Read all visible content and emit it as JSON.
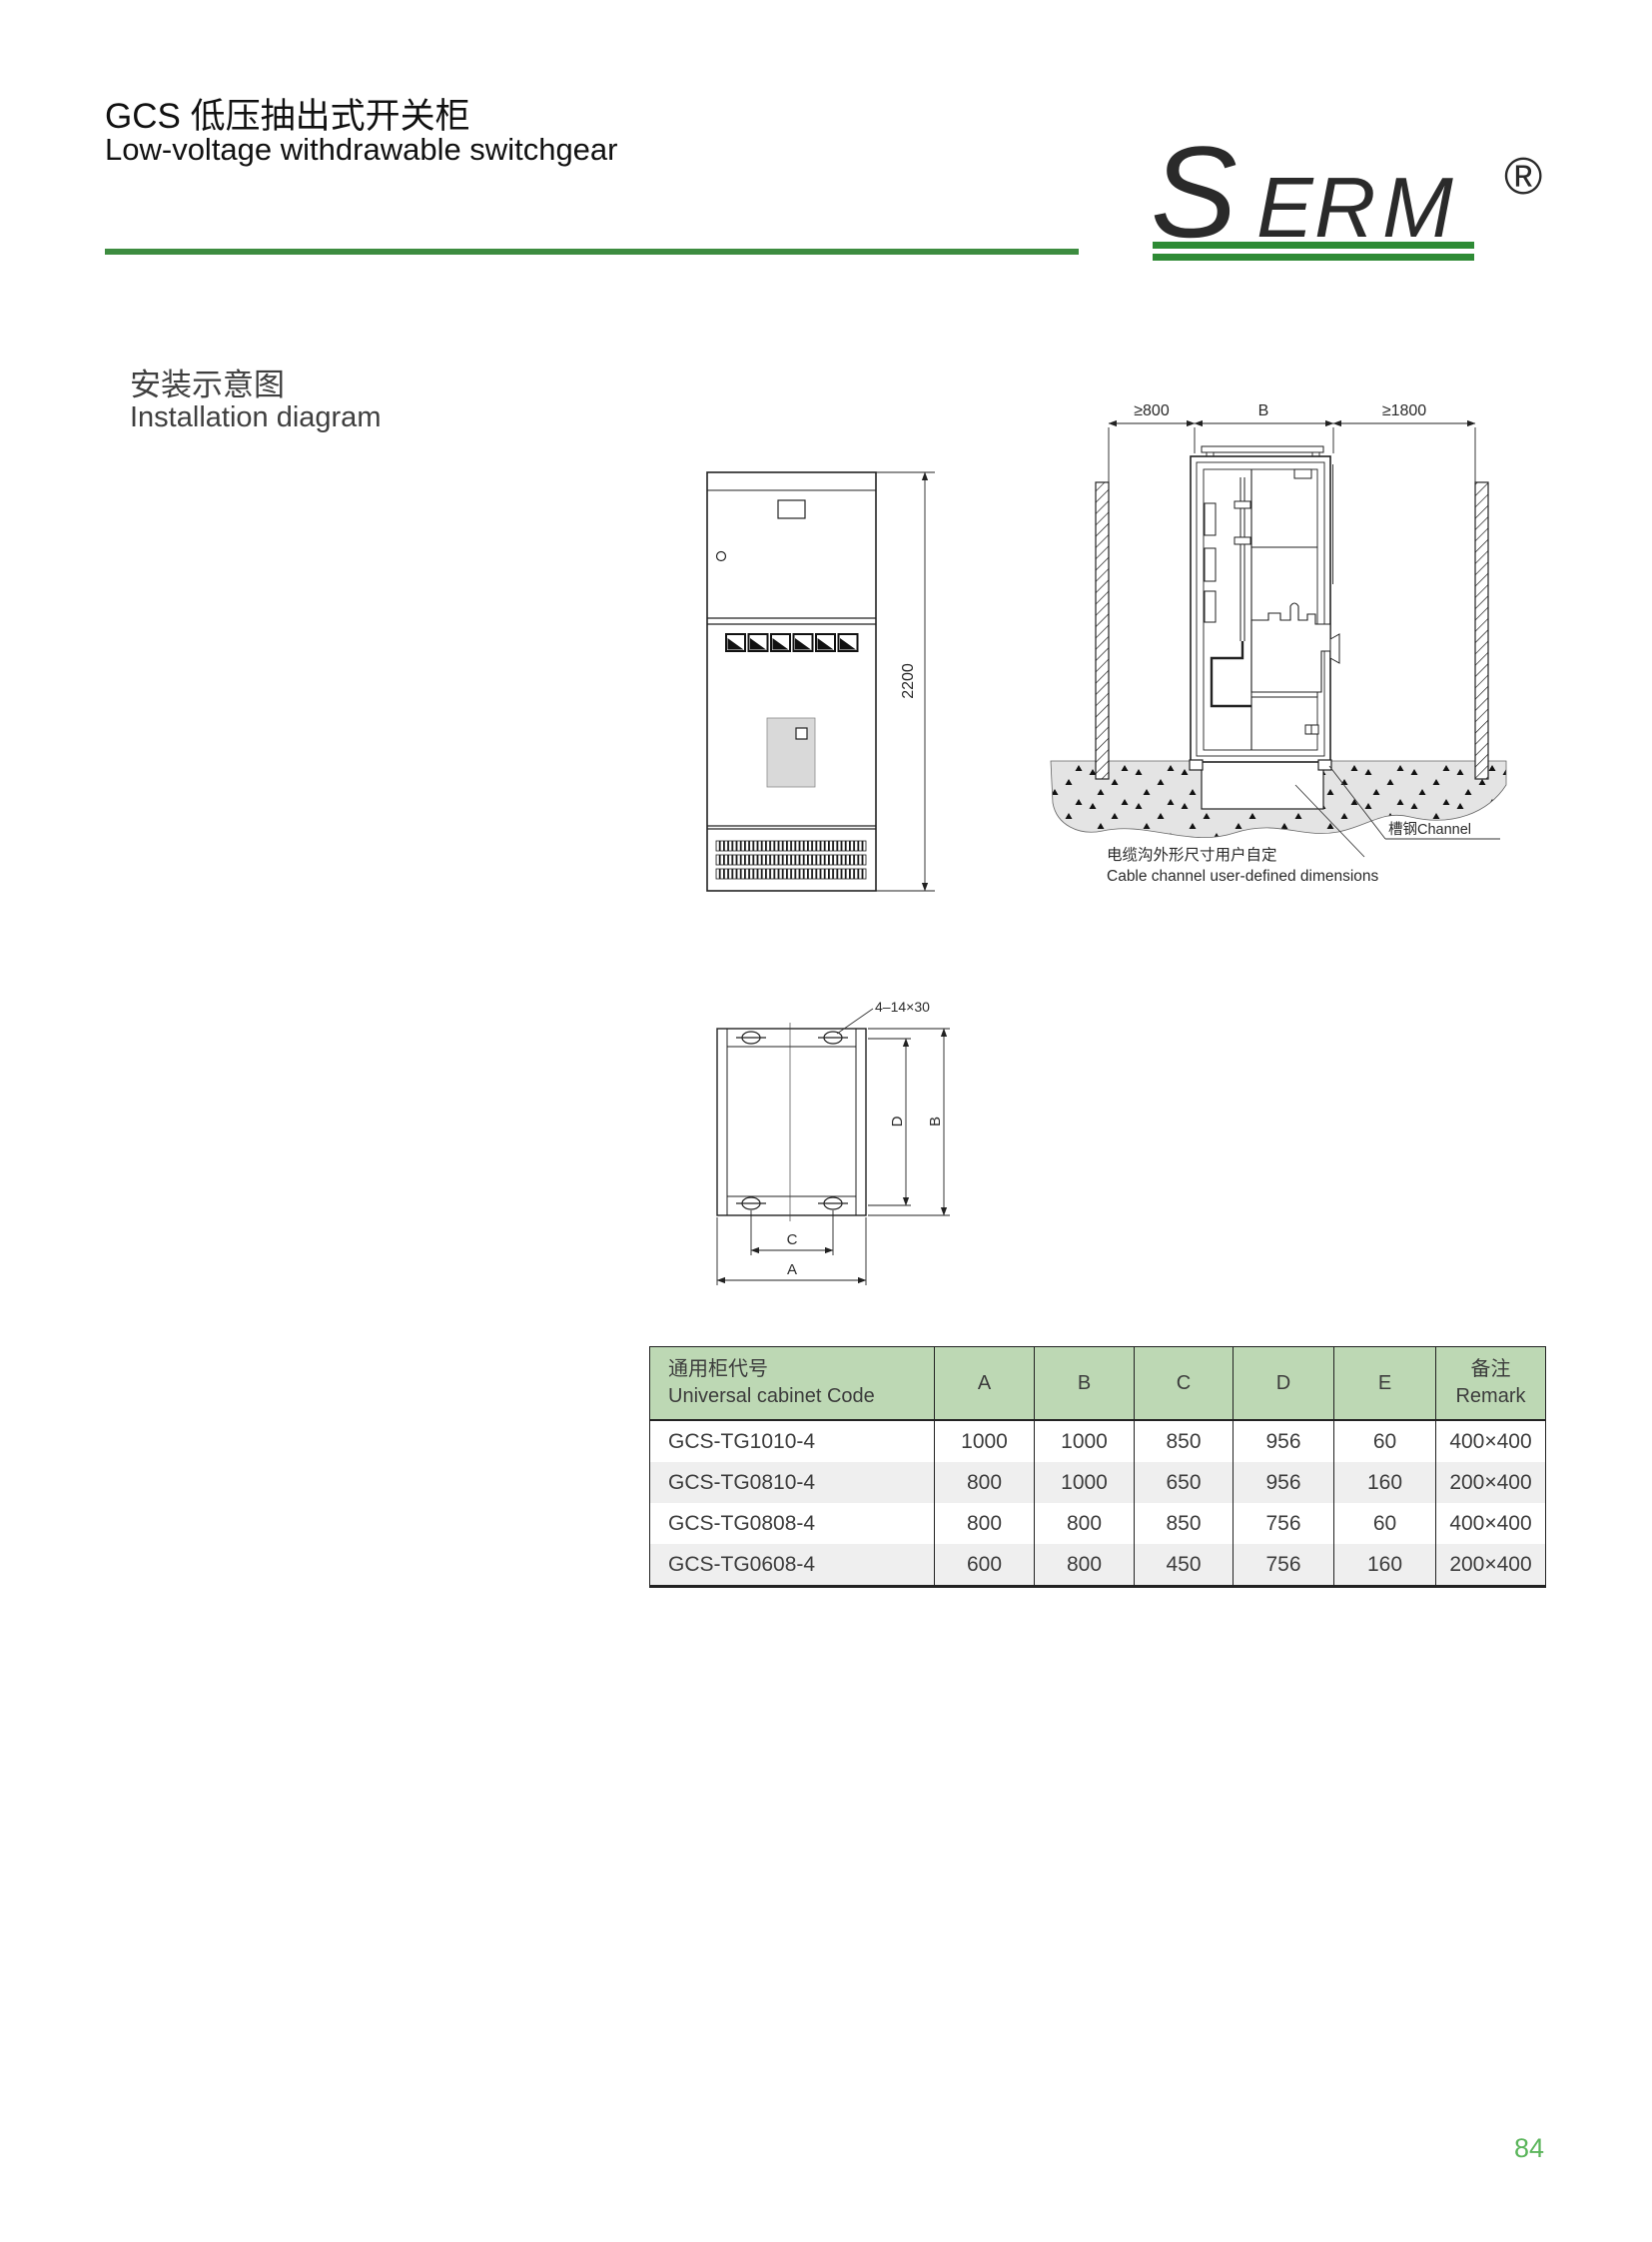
{
  "header": {
    "title_zh": "GCS 低压抽出式开关柜",
    "title_en": "Low-voltage withdrawable switchgear",
    "rule_color": "#3d8c40",
    "logo": {
      "s": "S",
      "e": "E",
      "r": "R",
      "m": "M",
      "registered": "®",
      "green": "#2e8b35",
      "red": "#8b1f1f"
    }
  },
  "section": {
    "title_zh": "安装示意图",
    "title_en": "Installation diagram"
  },
  "front_view": {
    "dim_height": "2200"
  },
  "cross_section": {
    "dim_left_clearance": "≥800",
    "dim_cabinet_width": "B",
    "dim_right_clearance": "≥1800",
    "channel_label": "槽钢Channel",
    "cable_note_zh": "电缆沟外形尺寸用户自定",
    "cable_note_en": "Cable channel user-defined dimensions"
  },
  "plan_view": {
    "holes_label": "4–14×30",
    "dim_a": "A",
    "dim_b": "B",
    "dim_c": "C",
    "dim_d": "D"
  },
  "table": {
    "header": {
      "code_zh": "通用柜代号",
      "code_en": "Universal cabinet Code",
      "col_a": "A",
      "col_b": "B",
      "col_c": "C",
      "col_d": "D",
      "col_e": "E",
      "remark_zh": "备注",
      "remark_en": "Remark"
    },
    "rows": [
      {
        "code": "GCS-TG1010-4",
        "a": "1000",
        "b": "1000",
        "c": "850",
        "d": "956",
        "e": "60",
        "remark": "400×400"
      },
      {
        "code": "GCS-TG0810-4",
        "a": "800",
        "b": "1000",
        "c": "650",
        "d": "956",
        "e": "160",
        "remark": "200×400"
      },
      {
        "code": "GCS-TG0808-4",
        "a": "800",
        "b": "800",
        "c": "850",
        "d": "756",
        "e": "60",
        "remark": "400×400"
      },
      {
        "code": "GCS-TG0608-4",
        "a": "600",
        "b": "800",
        "c": "450",
        "d": "756",
        "e": "160",
        "remark": "200×400"
      }
    ]
  },
  "footer": {
    "page_number": "84"
  },
  "colors": {
    "table_header_bg": "#bdd8b4",
    "row_alt_bg": "#efefef",
    "page_number_green": "#5bb55b"
  }
}
